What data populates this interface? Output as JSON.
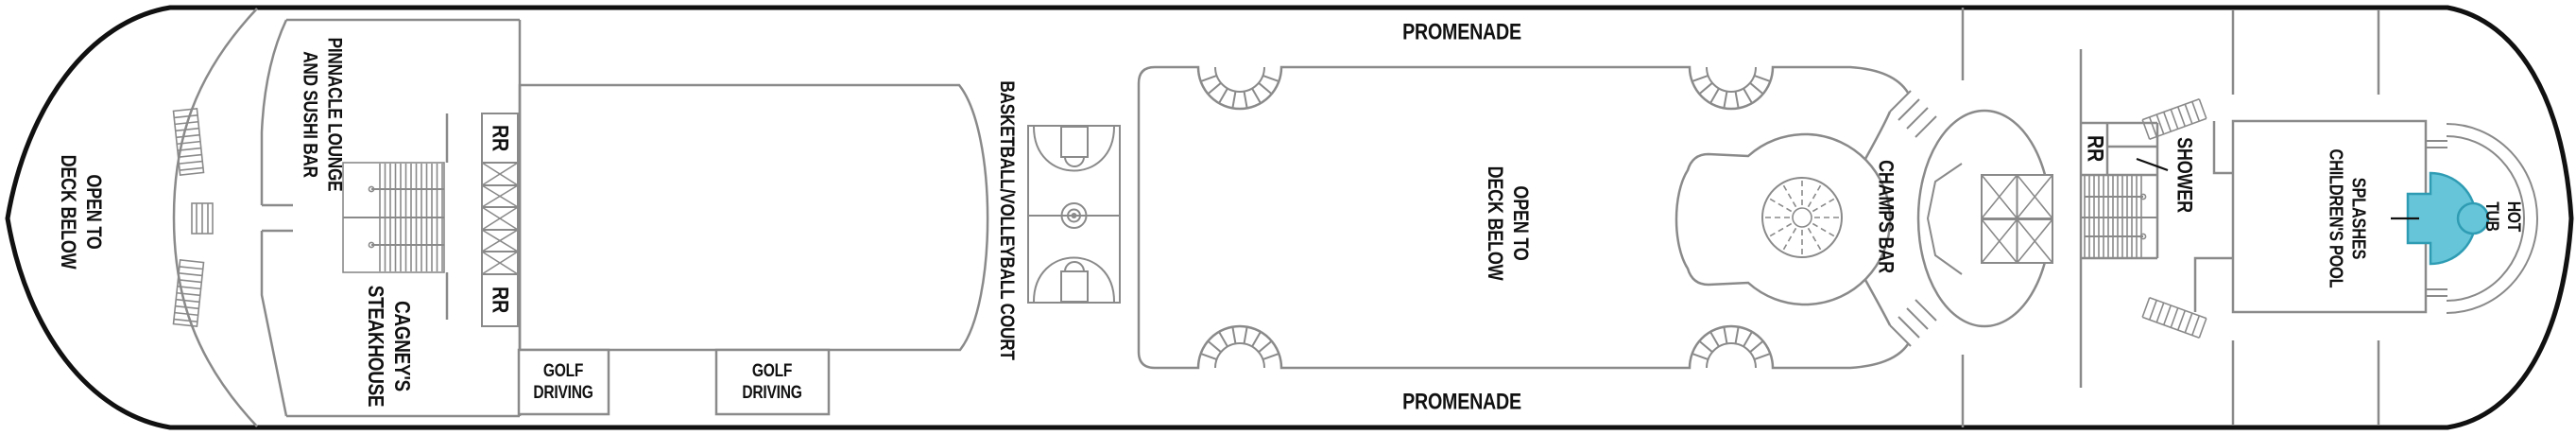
{
  "title": "Cruise ship deck plan",
  "colors": {
    "background": "#ffffff",
    "hull": "#111111",
    "line": "#8a8a8a",
    "text": "#111111",
    "pool_fill": "#66c5d8",
    "pool_border": "#2f9cb4"
  },
  "areas": {
    "bow_open_deck": {
      "label": "OPEN TO\nDECK BELOW"
    },
    "pinnacle_lounge": {
      "label": "PINNACLE LOUNGE\nAND SUSHI BAR"
    },
    "cagneys_steakhouse": {
      "label": "CAGNEY'S\nSTEAKHOUSE"
    },
    "restroom_forward_top": {
      "label": "RR"
    },
    "restroom_forward_bottom": {
      "label": "RR"
    },
    "golf_driving_1": {
      "label": "GOLF\nDRIVING"
    },
    "golf_driving_2": {
      "label": "GOLF\nDRIVING"
    },
    "basketball_court": {
      "label": "BASKETBALL/VOLLEYBALL COURT"
    },
    "promenade_top": {
      "label": "PROMENADE"
    },
    "promenade_bottom": {
      "label": "PROMENADE"
    },
    "mid_open_deck": {
      "label": "OPEN TO\nDECK BELOW"
    },
    "champs_bar": {
      "label": "CHAMPS BAR"
    },
    "restroom_aft": {
      "label": "RR"
    },
    "shower": {
      "label": "SHOWER"
    },
    "splashes_pool": {
      "label": "SPLASHES\nCHILDREN'S POOL"
    },
    "hot_tub": {
      "label": "HOT TUB"
    }
  }
}
